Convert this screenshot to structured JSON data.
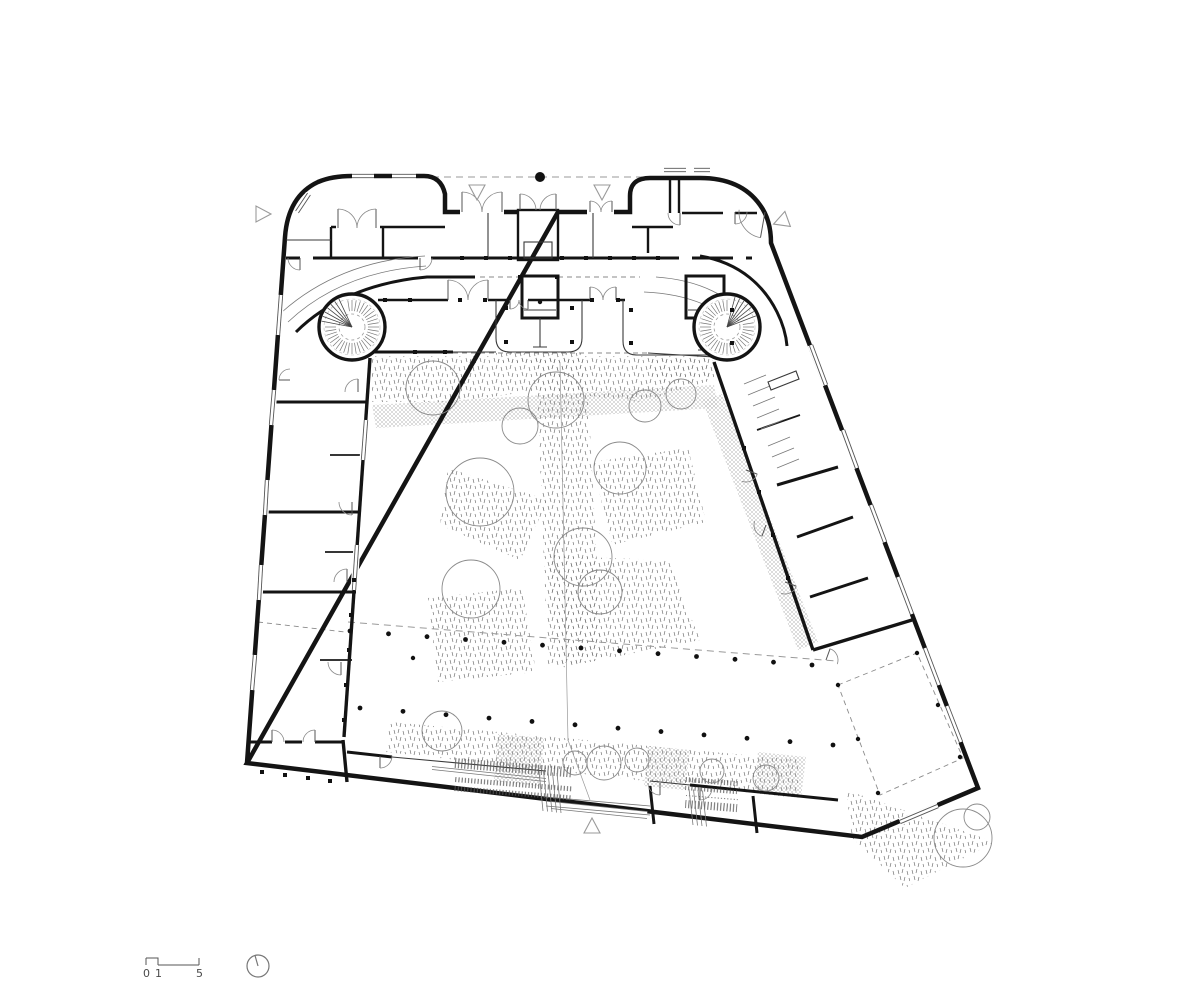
{
  "title": "ground-floor-plan",
  "colors": {
    "paper": "#ffffff",
    "wall": "#141414",
    "line": "#555555",
    "light": "#9a9a9a",
    "hatch": "#6f6f6f"
  },
  "scale_bar": {
    "labels": [
      "0",
      "1",
      "5"
    ]
  },
  "north_arrow": {
    "icon": "north-indicator",
    "cx": 258,
    "cy": 966,
    "r": 11,
    "tick_dx": -3,
    "tick_dy": -10.5
  },
  "annotations": {
    "column_dot": {
      "x": 540,
      "y": 177,
      "r": 5
    },
    "entrance_markers": [
      {
        "x": 262,
        "y": 214,
        "rot": 90
      },
      {
        "x": 477,
        "y": 191,
        "rot": 180
      },
      {
        "x": 602,
        "y": 191,
        "rot": 180
      },
      {
        "x": 782,
        "y": 221,
        "rot": 250
      },
      {
        "x": 592,
        "y": 827,
        "rot": 0
      }
    ]
  },
  "stairs": [
    {
      "cx": 352,
      "cy": 327,
      "r": 33,
      "inner_r": 13,
      "fan_angle": 218
    },
    {
      "cx": 727,
      "cy": 327,
      "r": 33,
      "inner_r": 13,
      "fan_angle": -48
    }
  ],
  "doors": [
    [
      462,
      212,
      20,
      -90,
      0
    ],
    [
      502,
      212,
      20,
      -90,
      180
    ],
    [
      590,
      212,
      11,
      -90,
      0
    ],
    [
      612,
      212,
      11,
      -90,
      180
    ],
    [
      520,
      210,
      16,
      -90,
      0
    ],
    [
      556,
      210,
      16,
      -90,
      180
    ],
    [
      338,
      228,
      19,
      -90,
      0
    ],
    [
      376,
      228,
      19,
      -90,
      180
    ],
    [
      300,
      258,
      12,
      90,
      180
    ],
    [
      420,
      258,
      12,
      90,
      0
    ],
    [
      680,
      213,
      12,
      90,
      180
    ],
    [
      735,
      212,
      12,
      90,
      0
    ],
    [
      765,
      212,
      26,
      100,
      185
    ],
    [
      448,
      300,
      20,
      -90,
      0
    ],
    [
      488,
      300,
      20,
      -90,
      180
    ],
    [
      510,
      300,
      9,
      90,
      0
    ],
    [
      528,
      300,
      9,
      90,
      180
    ],
    [
      590,
      300,
      13,
      -90,
      0
    ],
    [
      616,
      300,
      13,
      -90,
      180
    ],
    [
      358,
      392,
      13,
      -90,
      180
    ],
    [
      352,
      502,
      13,
      90,
      180
    ],
    [
      347,
      582,
      13,
      -90,
      180
    ],
    [
      341,
      662,
      13,
      90,
      180
    ],
    [
      290,
      380,
      11,
      180,
      270
    ],
    [
      272,
      742,
      12,
      -90,
      0
    ],
    [
      315,
      742,
      12,
      -90,
      180
    ],
    [
      380,
      756,
      12,
      90,
      0
    ],
    [
      660,
      783,
      12,
      90,
      180
    ],
    [
      700,
      788,
      12,
      90,
      0
    ],
    [
      746,
      470,
      12,
      20,
      110
    ],
    [
      766,
      525,
      12,
      110,
      200
    ],
    [
      785,
      582,
      12,
      20,
      110
    ],
    [
      826,
      660,
      12,
      -70,
      20
    ]
  ],
  "windows": [
    [
      281,
      295,
      278,
      335
    ],
    [
      274,
      390,
      271,
      425
    ],
    [
      267,
      480,
      265,
      515
    ],
    [
      261,
      565,
      259,
      600
    ],
    [
      255,
      655,
      252,
      690
    ],
    [
      297,
      212,
      309,
      194
    ],
    [
      352,
      176,
      374,
      176
    ],
    [
      392,
      176,
      416,
      176
    ],
    [
      664,
      170,
      686,
      170
    ],
    [
      694,
      170,
      710,
      170
    ],
    [
      811,
      345,
      826,
      385
    ],
    [
      843,
      430,
      857,
      468
    ],
    [
      871,
      505,
      885,
      542
    ],
    [
      898,
      577,
      912,
      614
    ],
    [
      925,
      648,
      939,
      685
    ],
    [
      947,
      706,
      961,
      742
    ],
    [
      900,
      822,
      938,
      806
    ],
    [
      366,
      420,
      363,
      460
    ],
    [
      357,
      545,
      354,
      590
    ]
  ],
  "mullions": [
    [
      462,
      258
    ],
    [
      486,
      258
    ],
    [
      510,
      258
    ],
    [
      562,
      258
    ],
    [
      586,
      258
    ],
    [
      610,
      258
    ],
    [
      634,
      258
    ],
    [
      658,
      258
    ],
    [
      520,
      277
    ],
    [
      557,
      277
    ],
    [
      385,
      300
    ],
    [
      410,
      300
    ],
    [
      460,
      300
    ],
    [
      485,
      300
    ],
    [
      592,
      300
    ],
    [
      618,
      300
    ],
    [
      506,
      342
    ],
    [
      572,
      342
    ],
    [
      506,
      308
    ],
    [
      572,
      308
    ],
    [
      631,
      343
    ],
    [
      732,
      343
    ],
    [
      631,
      310
    ],
    [
      732,
      310
    ],
    [
      354,
      580
    ],
    [
      351,
      615
    ],
    [
      349,
      650
    ],
    [
      346,
      685
    ],
    [
      344,
      720
    ],
    [
      262,
      772
    ],
    [
      285,
      775
    ],
    [
      308,
      778
    ],
    [
      330,
      781
    ],
    [
      744,
      448
    ],
    [
      759,
      492
    ],
    [
      773,
      535
    ],
    [
      788,
      578
    ],
    [
      415,
      352
    ],
    [
      445,
      352
    ]
  ],
  "landscape": {
    "trees": [
      [
        433,
        388,
        27
      ],
      [
        556,
        400,
        28
      ],
      [
        520,
        426,
        18
      ],
      [
        480,
        492,
        34
      ],
      [
        620,
        468,
        26
      ],
      [
        645,
        406,
        16
      ],
      [
        681,
        394,
        15
      ],
      [
        583,
        557,
        29
      ],
      [
        471,
        589,
        29
      ],
      [
        600,
        592,
        22
      ],
      [
        442,
        731,
        20
      ],
      [
        575,
        763,
        12
      ],
      [
        604,
        763,
        17
      ],
      [
        637,
        760,
        12
      ],
      [
        712,
        771,
        12
      ],
      [
        766,
        778,
        13
      ],
      [
        963,
        838,
        29
      ],
      [
        977,
        817,
        13
      ]
    ],
    "dot_rows": [
      {
        "x1": 350,
        "y1": 631,
        "x2": 812,
        "y2": 665,
        "n": 13
      },
      {
        "x1": 360,
        "y1": 708,
        "x2": 833,
        "y2": 745,
        "n": 12
      }
    ],
    "extra_dots": [
      [
        838,
        685
      ],
      [
        917,
        653
      ],
      [
        878,
        793
      ],
      [
        960,
        757
      ],
      [
        858,
        739
      ],
      [
        938,
        705
      ],
      [
        413,
        658
      ],
      [
        540,
        302
      ]
    ]
  }
}
